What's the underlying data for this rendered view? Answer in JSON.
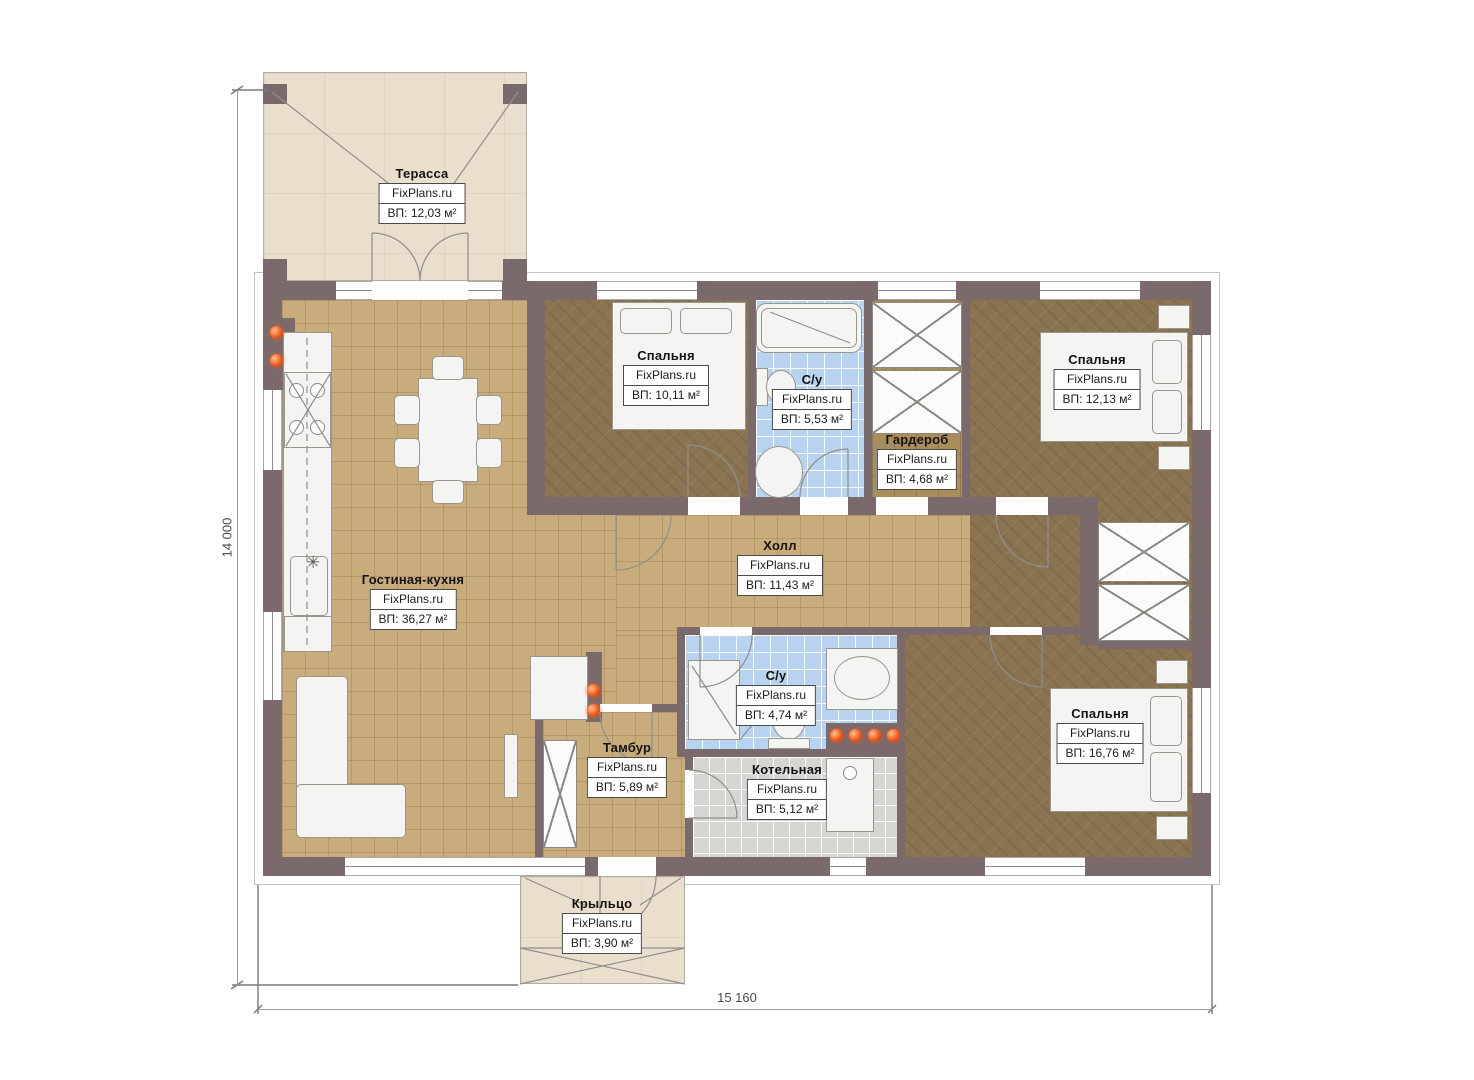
{
  "watermark": "FixPlans.ru",
  "dimensions": {
    "vertical": "14 000",
    "horizontal": "15 160"
  },
  "rooms": {
    "terrace": {
      "name": "Терасса",
      "area": "ВП: 12,03 м²"
    },
    "living": {
      "name": "Гостиная-кухня",
      "area": "ВП: 36,27 м²"
    },
    "bedroom1": {
      "name": "Спальня",
      "area": "ВП: 10,11 м²"
    },
    "bath1": {
      "name": "С/у",
      "area": "ВП: 5,53 м²"
    },
    "wardrobe": {
      "name": "Гардероб",
      "area": "ВП: 4,68 м²"
    },
    "bedroom2": {
      "name": "Спальня",
      "area": "ВП: 12,13 м²"
    },
    "hall": {
      "name": "Холл",
      "area": "ВП: 11,43 м²"
    },
    "bath2": {
      "name": "С/у",
      "area": "ВП: 4,74 м²"
    },
    "tambour": {
      "name": "Тамбур",
      "area": "ВП: 5,89 м²"
    },
    "boiler": {
      "name": "Котельная",
      "area": "ВП: 5,12 м²"
    },
    "bedroom3": {
      "name": "Спальня",
      "area": "ВП: 16,76 м²"
    },
    "porch": {
      "name": "Крыльцо",
      "area": "ВП: 3,90 м²"
    }
  },
  "colors": {
    "wall": "#7b6a6b",
    "floor_tile": "#c9ac7b",
    "floor_parquet": "#8a7350",
    "floor_bath": "#b7d3f0",
    "floor_boiler": "#d6d5d2",
    "floor_terrace": "#eadfcc",
    "accent_light": "#f05a1e"
  }
}
